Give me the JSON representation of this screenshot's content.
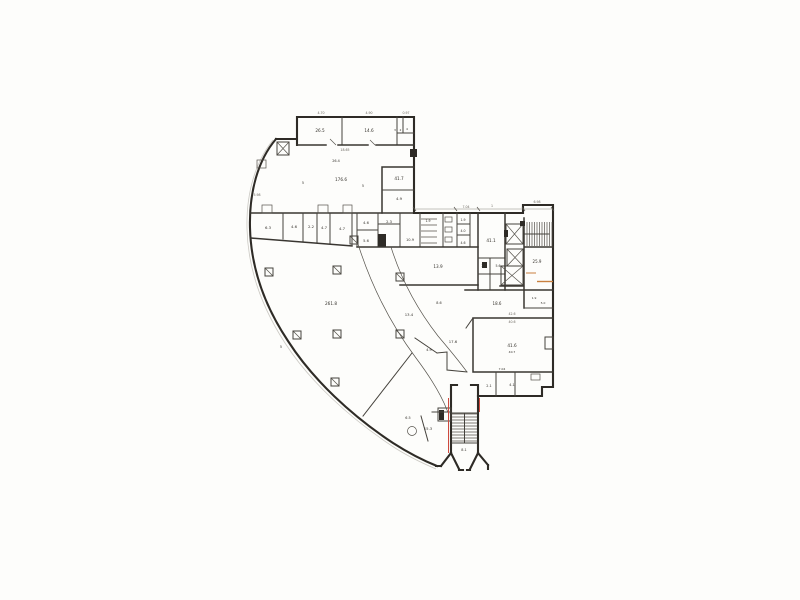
{
  "page": {
    "background": "#fdfdfb"
  },
  "plan": {
    "ink": "#34312b",
    "accent_red": "#cf4a3e",
    "accent_orange": "#c9803f",
    "room_labels": [
      {
        "t": "26.5",
        "x": 320,
        "y": 132,
        "s": 4.2
      },
      {
        "t": "14.6",
        "x": 369,
        "y": 132,
        "s": 4.2
      },
      {
        "t": "3",
        "x": 395,
        "y": 131,
        "s": 3
      },
      {
        "t": "2",
        "x": 400.5,
        "y": 131,
        "s": 3
      },
      {
        "t": "4",
        "x": 407,
        "y": 130,
        "s": 3
      },
      {
        "t": "26.4",
        "x": 336,
        "y": 162,
        "s": 3.4
      },
      {
        "t": "176.6",
        "x": 341,
        "y": 181,
        "s": 4.2
      },
      {
        "t": "5",
        "x": 303,
        "y": 184,
        "s": 3.4
      },
      {
        "t": "5",
        "x": 363,
        "y": 187,
        "s": 3.4
      },
      {
        "t": "41.7",
        "x": 399,
        "y": 180,
        "s": 4.2
      },
      {
        "t": "4.9",
        "x": 399,
        "y": 200,
        "s": 3.8
      },
      {
        "t": "6.3",
        "x": 268,
        "y": 229,
        "s": 3.8
      },
      {
        "t": "4.6",
        "x": 294,
        "y": 228,
        "s": 3.8
      },
      {
        "t": "2.2",
        "x": 311,
        "y": 228,
        "s": 3.8
      },
      {
        "t": "4.7",
        "x": 324,
        "y": 229,
        "s": 3.8
      },
      {
        "t": "4.7",
        "x": 342,
        "y": 230,
        "s": 3.8
      },
      {
        "t": "4.6",
        "x": 366,
        "y": 224,
        "s": 3.6
      },
      {
        "t": "2.3",
        "x": 389,
        "y": 223,
        "s": 3.6
      },
      {
        "t": "5.6",
        "x": 366,
        "y": 242,
        "s": 3.6
      },
      {
        "t": "1.9",
        "x": 428,
        "y": 222,
        "s": 3.2
      },
      {
        "t": "10.9",
        "x": 410,
        "y": 241,
        "s": 3.6
      },
      {
        "t": "1.9",
        "x": 463,
        "y": 221,
        "s": 3.2
      },
      {
        "t": "4.0",
        "x": 463,
        "y": 232,
        "s": 3.2
      },
      {
        "t": "4.6",
        "x": 463,
        "y": 244,
        "s": 3.2
      },
      {
        "t": "13.9",
        "x": 438,
        "y": 268,
        "s": 4.2
      },
      {
        "t": "41.1",
        "x": 491,
        "y": 242,
        "s": 4.2
      },
      {
        "t": "2.3",
        "x": 484,
        "y": 267,
        "s": 3.2
      },
      {
        "t": "5.6",
        "x": 498,
        "y": 267,
        "s": 3.2
      },
      {
        "t": "25.9",
        "x": 537,
        "y": 263,
        "s": 4
      },
      {
        "t": "18.6",
        "x": 497,
        "y": 305,
        "s": 4
      },
      {
        "t": "1.9",
        "x": 534,
        "y": 299,
        "s": 3
      },
      {
        "t": "5.0",
        "x": 543,
        "y": 304,
        "s": 3
      },
      {
        "t": "41.6",
        "x": 512,
        "y": 347,
        "s": 4.2
      },
      {
        "t": "40.7",
        "x": 512,
        "y": 353,
        "s": 3
      },
      {
        "t": "7.04",
        "x": 502,
        "y": 370,
        "s": 3
      },
      {
        "t": "2.1",
        "x": 489,
        "y": 387,
        "s": 3.4
      },
      {
        "t": "4.1",
        "x": 512,
        "y": 386,
        "s": 3.4
      },
      {
        "t": "13.4",
        "x": 409,
        "y": 316,
        "s": 3.8
      },
      {
        "t": "8.6",
        "x": 439,
        "y": 304,
        "s": 3.4
      },
      {
        "t": "4.9",
        "x": 429,
        "y": 351,
        "s": 3.4
      },
      {
        "t": "17.6",
        "x": 453,
        "y": 343,
        "s": 3.8
      },
      {
        "t": "15.3",
        "x": 428,
        "y": 430,
        "s": 3.8
      },
      {
        "t": "6.5",
        "x": 408,
        "y": 419,
        "s": 3.4
      },
      {
        "t": "8.1",
        "x": 464,
        "y": 451,
        "s": 3.4
      },
      {
        "t": "261.8",
        "x": 331,
        "y": 305,
        "s": 4.2
      },
      {
        "t": "5",
        "x": 281,
        "y": 348,
        "s": 3.4
      }
    ],
    "dim_labels": [
      {
        "t": "4.70",
        "x": 321,
        "y": 114
      },
      {
        "t": "4.90",
        "x": 369,
        "y": 114
      },
      {
        "t": "0.97",
        "x": 406,
        "y": 114
      },
      {
        "t": "18.65",
        "x": 345,
        "y": 151
      },
      {
        "t": "7.04",
        "x": 466,
        "y": 208
      },
      {
        "t": "1",
        "x": 492,
        "y": 207
      },
      {
        "t": "6.98",
        "x": 537,
        "y": 203
      },
      {
        "t": "42.6",
        "x": 512,
        "y": 315
      },
      {
        "t": "40.6",
        "x": 512,
        "y": 323
      },
      {
        "t": "5.98",
        "x": 257,
        "y": 196
      }
    ]
  }
}
